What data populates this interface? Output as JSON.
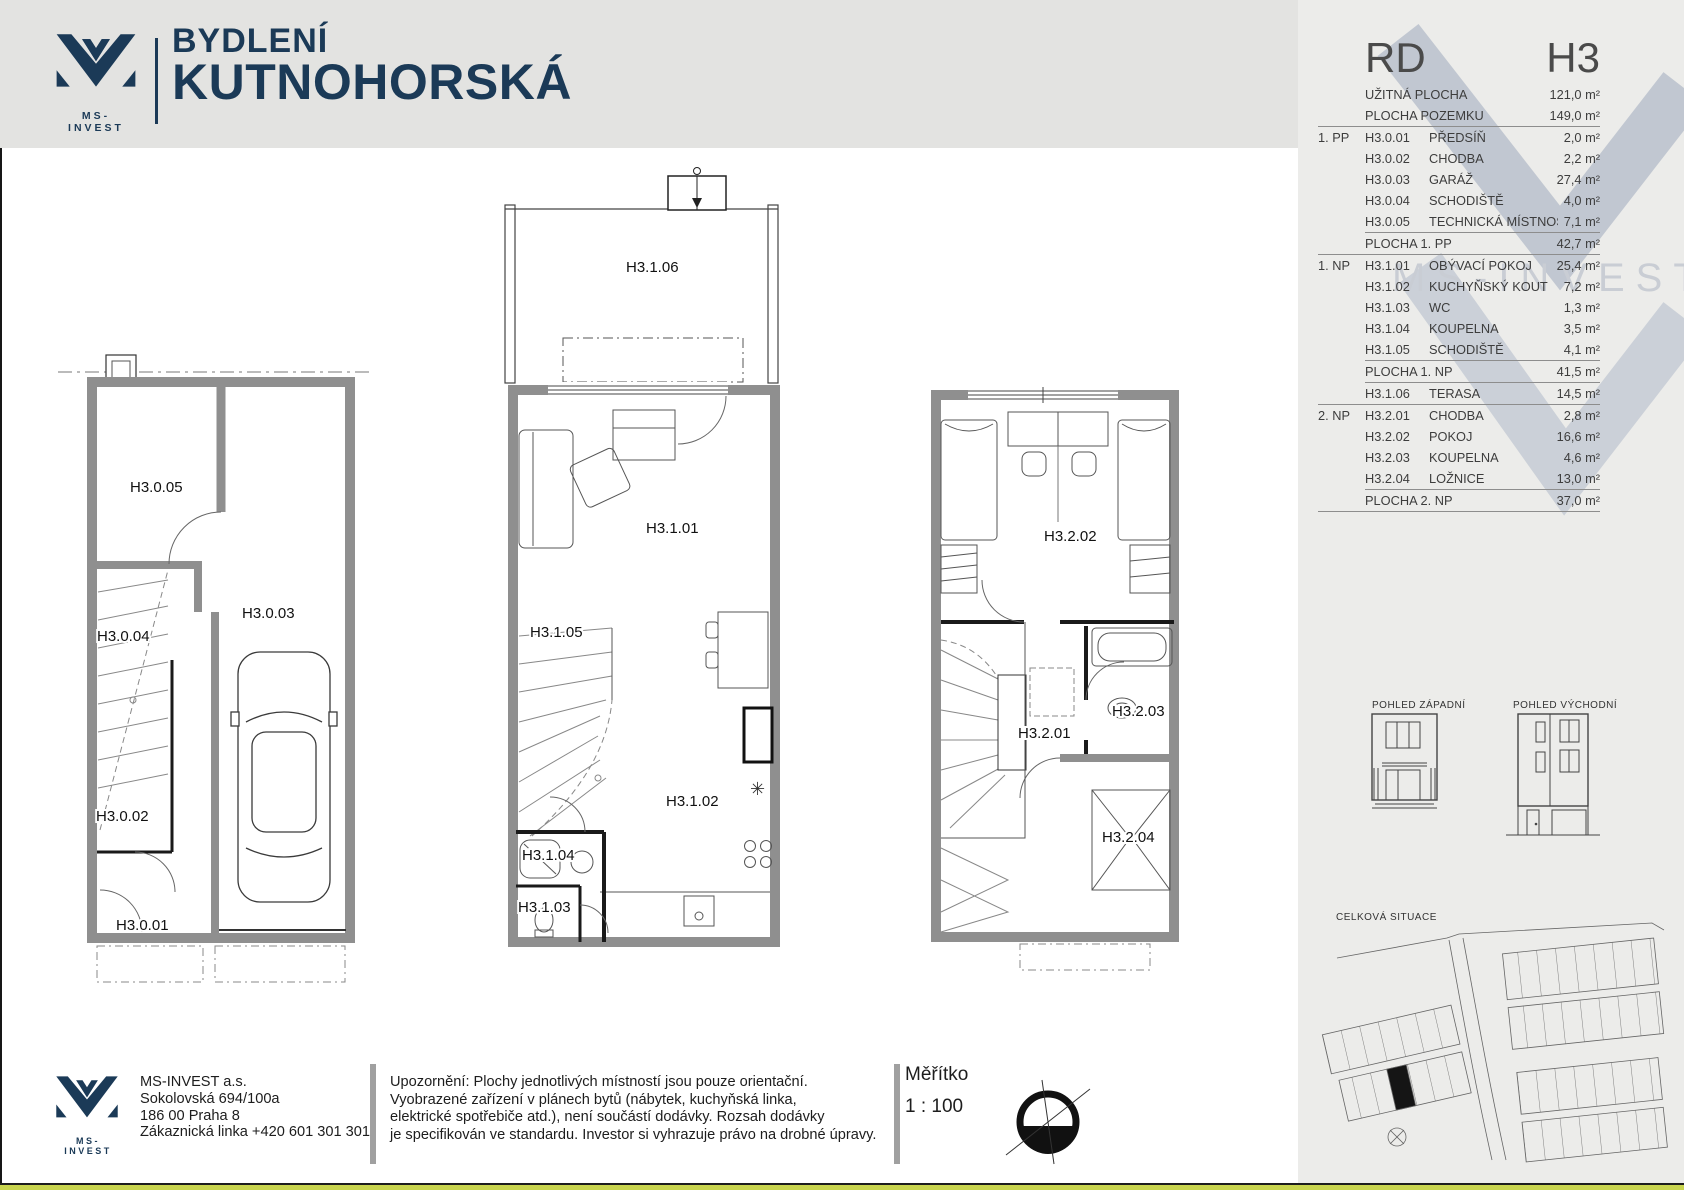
{
  "header": {
    "brand_caption": "MS-INVEST",
    "title1": "BYDLENÍ",
    "title2": "KUTNOHORSKÁ"
  },
  "panel": {
    "rd": "RD",
    "h3": "H3",
    "watermark": "MS-INVEST",
    "rows": [
      {
        "f": "",
        "c": "",
        "n": "UŽITNÁ PLOCHA",
        "v": "121,0 m²",
        "lb": ""
      },
      {
        "f": "",
        "c": "",
        "n": "PLOCHA POZEMKU",
        "v": "149,0 m²",
        "lb": "full"
      },
      {
        "f": "1. PP",
        "c": "H3.0.01",
        "n": "PŘEDSÍŇ",
        "v": "2,0 m²",
        "lb": ""
      },
      {
        "f": "",
        "c": "H3.0.02",
        "n": "CHODBA",
        "v": "2,2 m²",
        "lb": ""
      },
      {
        "f": "",
        "c": "H3.0.03",
        "n": "GARÁŽ",
        "v": "27,4 m²",
        "lb": ""
      },
      {
        "f": "",
        "c": "H3.0.04",
        "n": "SCHODIŠTĚ",
        "v": "4,0 m²",
        "lb": ""
      },
      {
        "f": "",
        "c": "H3.0.05",
        "n": "TECHNICKÁ MÍSTNOST",
        "v": "7,1 m²",
        "lb": "short"
      },
      {
        "f": "",
        "c": "",
        "n": "PLOCHA 1. PP",
        "v": "42,7 m²",
        "lb": "full"
      },
      {
        "f": "1. NP",
        "c": "H3.1.01",
        "n": "OBÝVACÍ POKOJ",
        "v": "25,4 m²",
        "lb": ""
      },
      {
        "f": "",
        "c": "H3.1.02",
        "n": "KUCHYŇSKÝ KOUT",
        "v": "7,2 m²",
        "lb": ""
      },
      {
        "f": "",
        "c": "H3.1.03",
        "n": "WC",
        "v": "1,3 m²",
        "lb": ""
      },
      {
        "f": "",
        "c": "H3.1.04",
        "n": "KOUPELNA",
        "v": "3,5 m²",
        "lb": ""
      },
      {
        "f": "",
        "c": "H3.1.05",
        "n": "SCHODIŠTĚ",
        "v": "4,1 m²",
        "lb": "short"
      },
      {
        "f": "",
        "c": "",
        "n": "PLOCHA 1. NP",
        "v": "41,5 m²",
        "lb": "short"
      },
      {
        "f": "",
        "c": "H3.1.06",
        "n": "TERASA",
        "v": "14,5 m²",
        "lb": "full"
      },
      {
        "f": "2. NP",
        "c": "H3.2.01",
        "n": "CHODBA",
        "v": "2,8 m²",
        "lb": ""
      },
      {
        "f": "",
        "c": "H3.2.02",
        "n": "POKOJ",
        "v": "16,6 m²",
        "lb": ""
      },
      {
        "f": "",
        "c": "H3.2.03",
        "n": "KOUPELNA",
        "v": "4,6 m²",
        "lb": ""
      },
      {
        "f": "",
        "c": "H3.2.04",
        "n": "LOŽNICE",
        "v": "13,0 m²",
        "lb": "short"
      },
      {
        "f": "",
        "c": "",
        "n": "PLOCHA 2. NP",
        "v": "37,0 m²",
        "lb": "full"
      }
    ]
  },
  "plans": {
    "pp": {
      "r01": "H3.0.01",
      "r02": "H3.0.02",
      "r03": "H3.0.03",
      "r04": "H3.0.04",
      "r05": "H3.0.05"
    },
    "np1": {
      "r01": "H3.1.01",
      "r02": "H3.1.02",
      "r03": "H3.1.03",
      "r04": "H3.1.04",
      "r05": "H3.1.05",
      "r06": "H3.1.06"
    },
    "np2": {
      "r01": "H3.2.01",
      "r02": "H3.2.02",
      "r03": "H3.2.03",
      "r04": "H3.2.04"
    }
  },
  "views": {
    "west": "POHLED ZÁPADNÍ",
    "east": "POHLED VÝCHODNÍ",
    "situation": "CELKOVÁ SITUACE"
  },
  "footer": {
    "company": {
      "name": "MS-INVEST  a.s.",
      "address1": "Sokolovská 694/100a",
      "address2": "186 00 Praha 8",
      "phone": "Zákaznická linka +420 601 301 301",
      "logo_caption": "MS-INVEST"
    },
    "disclaimer": "Upozornění: Plochy jednotlivých místností jsou pouze orientační.\nVyobrazené zařízení v plánech bytů (nábytek, kuchyňská linka,\nelektrické spotřebiče atd.), není součástí dodávky. Rozsah dodávky\nje specifikován ve standardu. Investor si vyhrazuje právo na drobné úpravy.",
    "scale_label": "Měřítko",
    "scale_value": "1 : 100"
  },
  "colors": {
    "navy": "#1b3a57",
    "accent_green": "#c8d44e",
    "wall_gray": "#8f8f8f",
    "watermark": "#aab3c3"
  }
}
